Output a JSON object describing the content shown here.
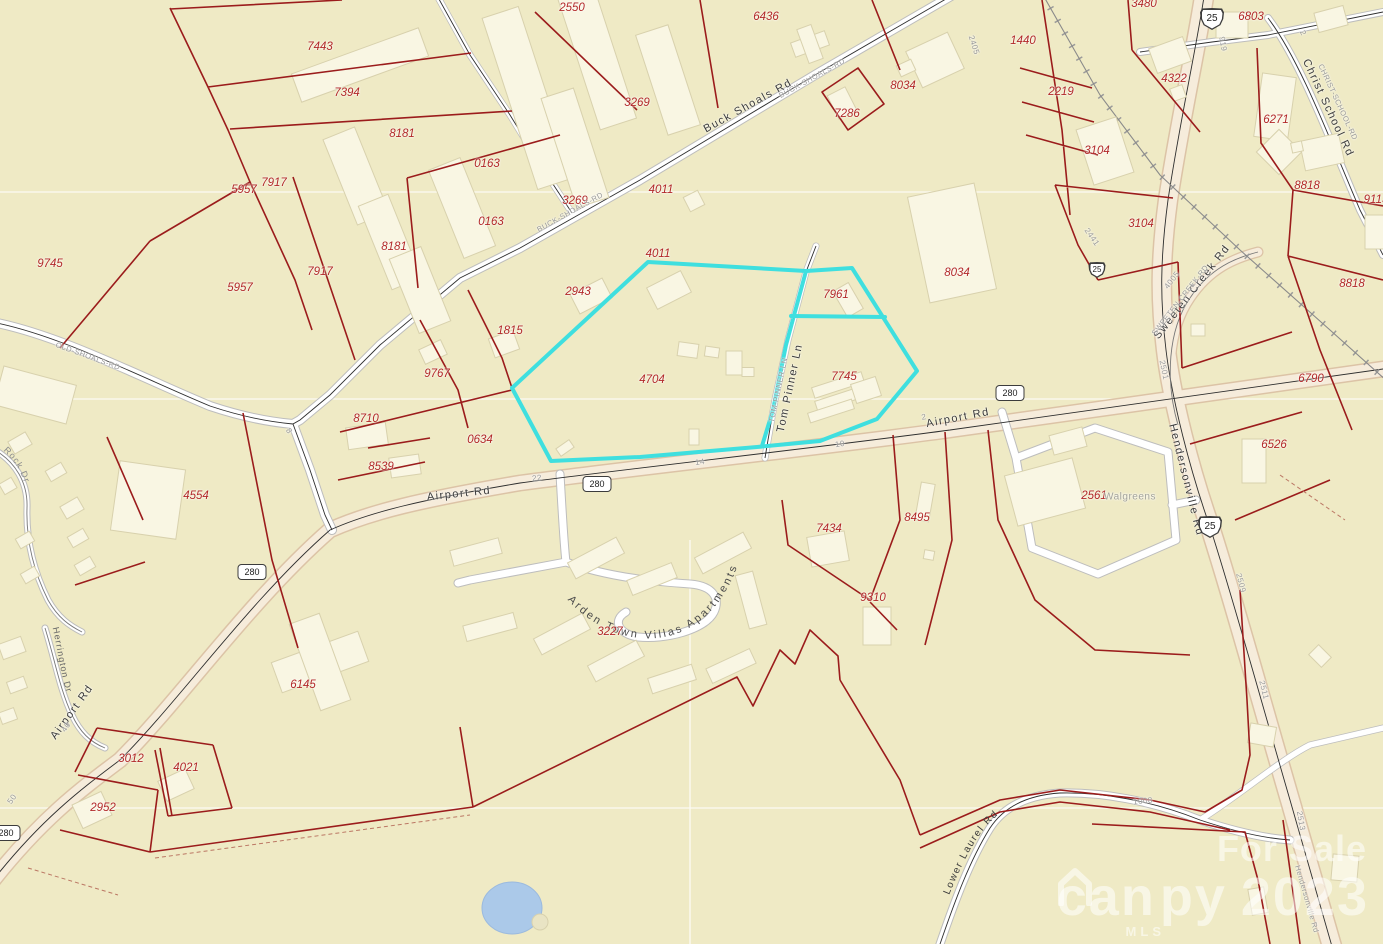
{
  "map": {
    "colors": {
      "background": "#efeac5",
      "parcel_line": "#9b1c1c",
      "building_fill": "#f9f6e3",
      "building_stroke": "#d8d1ad",
      "highlight": "#3fdfdf",
      "road_fill": "#ffffff",
      "highway_fill": "#f6ecdb",
      "pond_fill": "#abc9e9",
      "parcel_label": "#b22828",
      "road_label": "#3a3a3a",
      "street_label": "#999999",
      "watermark": "rgba(255,255,255,0.55)"
    },
    "parcel_labels": [
      {
        "t": "7443",
        "x": 320,
        "y": 47
      },
      {
        "t": "7394",
        "x": 347,
        "y": 93
      },
      {
        "t": "2550",
        "x": 572,
        "y": 8
      },
      {
        "t": "3269",
        "x": 637,
        "y": 103
      },
      {
        "t": "6436",
        "x": 766,
        "y": 17
      },
      {
        "t": "8034",
        "x": 903,
        "y": 86
      },
      {
        "t": "7286",
        "x": 847,
        "y": 114
      },
      {
        "t": "8181",
        "x": 402,
        "y": 134
      },
      {
        "t": "0163",
        "x": 487,
        "y": 164
      },
      {
        "t": "7917",
        "x": 274,
        "y": 183
      },
      {
        "t": "5957",
        "x": 244,
        "y": 190
      },
      {
        "t": "3269",
        "x": 575,
        "y": 201
      },
      {
        "t": "4011",
        "x": 661,
        "y": 190
      },
      {
        "t": "0163",
        "x": 491,
        "y": 222
      },
      {
        "t": "8181",
        "x": 394,
        "y": 247
      },
      {
        "t": "7917",
        "x": 320,
        "y": 272
      },
      {
        "t": "5957",
        "x": 240,
        "y": 288
      },
      {
        "t": "9745",
        "x": 50,
        "y": 264
      },
      {
        "t": "2943",
        "x": 578,
        "y": 292
      },
      {
        "t": "4011",
        "x": 658,
        "y": 254
      },
      {
        "t": "7961",
        "x": 836,
        "y": 295
      },
      {
        "t": "8034",
        "x": 957,
        "y": 273
      },
      {
        "t": "1440",
        "x": 1023,
        "y": 41
      },
      {
        "t": "2219",
        "x": 1061,
        "y": 92
      },
      {
        "t": "4322",
        "x": 1174,
        "y": 79
      },
      {
        "t": "3480",
        "x": 1144,
        "y": 4
      },
      {
        "t": "3104",
        "x": 1097,
        "y": 151
      },
      {
        "t": "3104",
        "x": 1141,
        "y": 224
      },
      {
        "t": "6271",
        "x": 1276,
        "y": 120
      },
      {
        "t": "8818",
        "x": 1307,
        "y": 186
      },
      {
        "t": "9113",
        "x": 1376,
        "y": 200
      },
      {
        "t": "6803",
        "x": 1251,
        "y": 17
      },
      {
        "t": "6790",
        "x": 1311,
        "y": 379
      },
      {
        "t": "8818",
        "x": 1352,
        "y": 284
      },
      {
        "t": "6526",
        "x": 1274,
        "y": 445
      },
      {
        "t": "1815",
        "x": 510,
        "y": 331
      },
      {
        "t": "9767",
        "x": 437,
        "y": 374
      },
      {
        "t": "8710",
        "x": 366,
        "y": 419
      },
      {
        "t": "0634",
        "x": 480,
        "y": 440
      },
      {
        "t": "8539",
        "x": 381,
        "y": 467
      },
      {
        "t": "4554",
        "x": 196,
        "y": 496
      },
      {
        "t": "4704",
        "x": 652,
        "y": 380
      },
      {
        "t": "7745",
        "x": 844,
        "y": 377
      },
      {
        "t": "2561",
        "x": 1094,
        "y": 496
      },
      {
        "t": "8495",
        "x": 917,
        "y": 518
      },
      {
        "t": "7434",
        "x": 829,
        "y": 529
      },
      {
        "t": "9310",
        "x": 873,
        "y": 598
      },
      {
        "t": "3227",
        "x": 610,
        "y": 632
      },
      {
        "t": "6145",
        "x": 303,
        "y": 685
      },
      {
        "t": "3012",
        "x": 131,
        "y": 759
      },
      {
        "t": "4021",
        "x": 186,
        "y": 768
      },
      {
        "t": "2952",
        "x": 103,
        "y": 808
      }
    ],
    "road_labels": [
      {
        "t": "Buck Shoals Rd",
        "x": 748,
        "y": 106,
        "rot": -29
      },
      {
        "t": "Airport Rd",
        "x": 459,
        "y": 494,
        "rot": -6
      },
      {
        "t": "Airport Rd",
        "x": 958,
        "y": 418,
        "rot": -11
      },
      {
        "t": "Airport Rd",
        "x": 72,
        "y": 712,
        "rot": -54
      },
      {
        "t": "Tom Pinner Ln",
        "x": 790,
        "y": 388,
        "rot": -78
      },
      {
        "t": "Hendersonville Rd",
        "x": 1186,
        "y": 480,
        "rot": 76
      },
      {
        "t": "Sweeten Creek Rd",
        "x": 1192,
        "y": 292,
        "rot": -52
      },
      {
        "t": "Christ School Rd",
        "x": 1328,
        "y": 108,
        "rot": 65
      }
    ],
    "street_labels": [
      {
        "t": "BUCK-SHOALS-RD",
        "x": 570,
        "y": 212,
        "rot": -29
      },
      {
        "t": "BUCK-SHOALS-RD",
        "x": 812,
        "y": 78,
        "rot": -29
      },
      {
        "t": "OLD-SHOALS-RD",
        "x": 88,
        "y": 356,
        "rot": 20
      },
      {
        "t": "TOM-PINNER-LN",
        "x": 778,
        "y": 390,
        "rot": -78
      },
      {
        "t": "SWEETEN-CREEK-RD",
        "x": 1180,
        "y": 300,
        "rot": -52
      },
      {
        "t": "CHRIST-SCHOOL-RD",
        "x": 1338,
        "y": 102,
        "rot": 65
      },
      {
        "t": "Hendersonville Rd",
        "x": 1307,
        "y": 899,
        "rot": 74
      }
    ],
    "segment_labels": [
      {
        "t": "22",
        "x": 537,
        "y": 478,
        "rot": -6
      },
      {
        "t": "14",
        "x": 700,
        "y": 462,
        "rot": -7
      },
      {
        "t": "10",
        "x": 840,
        "y": 444,
        "rot": -9
      },
      {
        "t": "2",
        "x": 924,
        "y": 417,
        "rot": -11
      },
      {
        "t": "8",
        "x": 289,
        "y": 431,
        "rot": 58
      },
      {
        "t": "40",
        "x": 66,
        "y": 727,
        "rot": -56
      },
      {
        "t": "50",
        "x": 12,
        "y": 799,
        "rot": -56
      },
      {
        "t": "2405",
        "x": 974,
        "y": 45,
        "rot": 72
      },
      {
        "t": "919",
        "x": 1223,
        "y": 44,
        "rot": 80
      },
      {
        "t": "2441",
        "x": 1092,
        "y": 237,
        "rot": 55
      },
      {
        "t": "2501",
        "x": 1164,
        "y": 370,
        "rot": 78
      },
      {
        "t": "2509",
        "x": 1241,
        "y": 583,
        "rot": 76
      },
      {
        "t": "2511",
        "x": 1264,
        "y": 690,
        "rot": 76
      },
      {
        "t": "2513",
        "x": 1301,
        "y": 821,
        "rot": 80
      },
      {
        "t": "1008",
        "x": 1143,
        "y": 801,
        "rot": -6
      },
      {
        "t": "4005",
        "x": 1172,
        "y": 280,
        "rot": -52
      },
      {
        "t": "2",
        "x": 1303,
        "y": 33,
        "rot": 65
      }
    ],
    "poi_labels": [
      {
        "t": "Walgreens",
        "x": 1130,
        "y": 497
      }
    ],
    "curved_labels": {
      "arden": "Arden Town Villas Apartments",
      "lower_laurel": "Lower Laurel Rd",
      "herrington": "Herrington Dr",
      "rock": "Rock Dr"
    },
    "shields": [
      {
        "type": "us",
        "t": "25",
        "x": 1212,
        "y": 19
      },
      {
        "type": "us",
        "t": "25",
        "x": 1097,
        "y": 270,
        "small": true
      },
      {
        "type": "us",
        "t": "25",
        "x": 1210,
        "y": 527
      },
      {
        "type": "nc",
        "t": "280",
        "x": 597,
        "y": 484
      },
      {
        "type": "nc",
        "t": "280",
        "x": 252,
        "y": 572
      },
      {
        "type": "nc",
        "t": "280",
        "x": 1010,
        "y": 393
      },
      {
        "type": "nc",
        "t": "280",
        "x": 6,
        "y": 833
      }
    ],
    "watermark": {
      "for_sale": "For Sale",
      "brand_prefix": "can",
      "brand_suffix": "py",
      "year": "2023",
      "mls": "MLS"
    }
  }
}
